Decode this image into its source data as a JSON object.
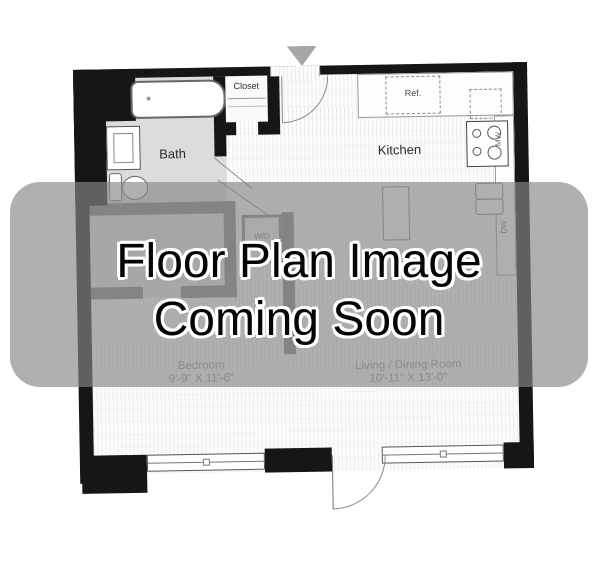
{
  "overlay": {
    "line1": "Floor Plan Image",
    "line2": "Coming Soon"
  },
  "floor_plan": {
    "rooms": {
      "bath": {
        "label": "Bath"
      },
      "entry_closet": {
        "label": "Closet"
      },
      "kitchen": {
        "label": "Kitchen"
      },
      "bedroom_closet": {
        "label": "Closet"
      },
      "laundry_closet": {
        "label": "W/D"
      },
      "bedroom": {
        "label": "Bedroom",
        "dimensions": "9'-9\" X 11'-6\""
      },
      "living_dining": {
        "label": "Living / Dining Room",
        "dimensions": "10'-11\" X 13'-0\""
      }
    },
    "appliances": {
      "refrigerator": {
        "label": "Ref."
      },
      "microwave": {
        "label": "MW"
      },
      "dishwasher": {
        "label": "DW"
      }
    }
  },
  "colors": {
    "wall": "#161616",
    "overlay": "#888888",
    "overlay_text": "#000000",
    "dimension_text": "#8f8f8f"
  }
}
